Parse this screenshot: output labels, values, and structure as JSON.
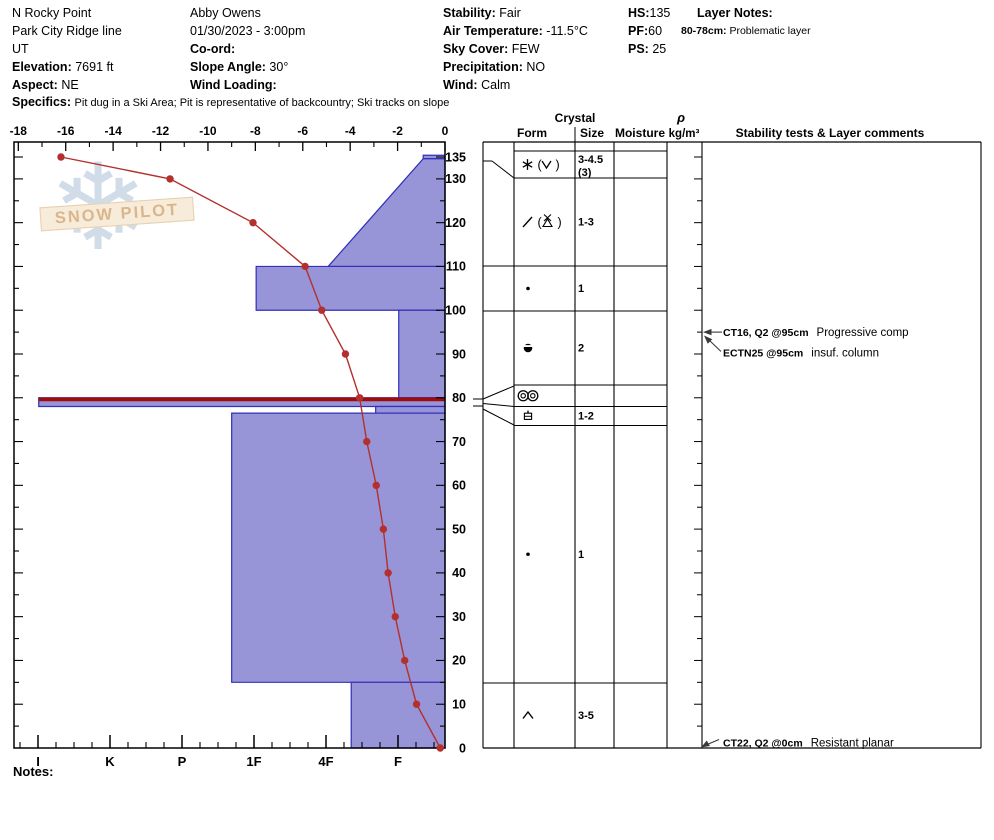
{
  "page": {
    "notes_label": "Notes:"
  },
  "header": {
    "site_name": "N Rocky Point",
    "site_line2": "Park City Ridge line",
    "state": "UT",
    "elevation_label": "Elevation:",
    "elevation_value": "7691 ft",
    "aspect_label": "Aspect:",
    "aspect_value": "NE",
    "specifics_label": "Specifics:",
    "specifics_value": "Pit dug in a Ski Area;  Pit is representative of backcountry;  Ski tracks on slope",
    "observer": "Abby Owens",
    "datetime": "01/30/2023 - 3:00pm",
    "coord_label": "Co-ord:",
    "coord_value": "",
    "slope_angle_label": "Slope Angle:",
    "slope_angle_value": "30°",
    "wind_loading_label": "Wind Loading:",
    "wind_loading_value": "",
    "stability_label": "Stability:",
    "stability_value": "Fair",
    "air_temp_label": "Air Temperature:",
    "air_temp_value": "-11.5°C",
    "sky_cover_label": "Sky Cover:",
    "sky_cover_value": "FEW",
    "precipitation_label": "Precipitation:",
    "precipitation_value": "NO",
    "wind_label": "Wind:",
    "wind_value": "Calm",
    "hs_label": "HS:",
    "hs_value": "135",
    "pf_label": "PF:",
    "pf_value": "60",
    "ps_label": "PS:",
    "ps_value": "25",
    "layer_notes_label": "Layer Notes:",
    "layer_note_depth": "80-78cm:",
    "layer_note_text": "Problematic layer"
  },
  "watermark": {
    "text": "SNOW PILOT",
    "snowflake_icon": "snowflake"
  },
  "chart_data": {
    "type": "snow-profile",
    "temp_axis": {
      "position": "top",
      "unit": "°C",
      "min": -18,
      "max": 0,
      "major_tick_step": 2,
      "minor_tick_step": 1,
      "labels": [
        -18,
        -16,
        -14,
        -12,
        -10,
        -8,
        -6,
        -4,
        -2,
        0
      ]
    },
    "depth_axis": {
      "position": "right",
      "unit": "cm",
      "min": 0,
      "max": 135,
      "minor_tick_step": 5,
      "labels": [
        135,
        130,
        120,
        110,
        100,
        90,
        80,
        70,
        60,
        50,
        40,
        30,
        20,
        10,
        0
      ]
    },
    "hardness_axis": {
      "position": "bottom",
      "labels": [
        "I",
        "K",
        "P",
        "1F",
        "4F",
        "F"
      ]
    },
    "temperature_profile": [
      {
        "depth_cm": 135,
        "temp_c": -16.2
      },
      {
        "depth_cm": 130,
        "temp_c": -11.6
      },
      {
        "depth_cm": 120,
        "temp_c": -8.1
      },
      {
        "depth_cm": 110,
        "temp_c": -5.9
      },
      {
        "depth_cm": 100,
        "temp_c": -5.2
      },
      {
        "depth_cm": 90,
        "temp_c": -4.2
      },
      {
        "depth_cm": 80,
        "temp_c": -3.6
      },
      {
        "depth_cm": 70,
        "temp_c": -3.3
      },
      {
        "depth_cm": 60,
        "temp_c": -2.9
      },
      {
        "depth_cm": 50,
        "temp_c": -2.6
      },
      {
        "depth_cm": 40,
        "temp_c": -2.4
      },
      {
        "depth_cm": 30,
        "temp_c": -2.1
      },
      {
        "depth_cm": 20,
        "temp_c": -1.7
      },
      {
        "depth_cm": 10,
        "temp_c": -1.2
      },
      {
        "depth_cm": 0,
        "temp_c": -0.2
      }
    ],
    "layers": [
      {
        "top_cm": 135.4,
        "bottom_cm": 134.6,
        "hardness": "F-",
        "h_top": 0.65,
        "h_bottom": 0.65
      },
      {
        "top_cm": 134.6,
        "bottom_cm": 110,
        "hardness": "F- to 4F",
        "h_top": 0.65,
        "h_bottom": 1.97
      },
      {
        "top_cm": 110,
        "bottom_cm": 100,
        "hardness": "1F",
        "h_top": 2.97,
        "h_bottom": 2.97
      },
      {
        "top_cm": 100,
        "bottom_cm": 80,
        "hardness": "F",
        "h_top": 0.99,
        "h_bottom": 0.99
      },
      {
        "top_cm": 80,
        "bottom_cm": 78,
        "hardness": "I",
        "h_top": 5.99,
        "h_bottom": 5.99,
        "flagged": true
      },
      {
        "top_cm": 78,
        "bottom_cm": 76.5,
        "hardness": "F+",
        "h_top": 1.31,
        "h_bottom": 1.31
      },
      {
        "top_cm": 76.5,
        "bottom_cm": 15,
        "hardness": "1F+",
        "h_top": 3.31,
        "h_bottom": 3.31
      },
      {
        "top_cm": 15,
        "bottom_cm": 0,
        "hardness": "4F-F",
        "h_top": 1.65,
        "h_bottom": 1.65
      }
    ],
    "grain_rows": [
      {
        "forms": [],
        "size_lines": []
      },
      {
        "forms": [
          "new-snow-star",
          "paren-open",
          "surface-hoar-v",
          "paren-close"
        ],
        "size_lines": [
          "3-4.5",
          "(3)"
        ]
      },
      {
        "forms": [
          "decomposing-slash",
          "paren-open",
          "graupel-triangle-x",
          "paren-close"
        ],
        "size_lines": [
          "1-3"
        ]
      },
      {
        "forms": [
          "rounded-grain-dot"
        ],
        "size_lines": [
          "1"
        ]
      },
      {
        "forms": [
          "circle-notched"
        ],
        "size_lines": [
          "2"
        ]
      },
      {
        "forms": [
          "double-ring-crust"
        ],
        "size_lines": []
      },
      {
        "forms": [
          "square-notched"
        ],
        "size_lines": [
          "1-2"
        ]
      },
      {
        "forms": [
          "rounded-grain-dot"
        ],
        "size_lines": [
          "1"
        ]
      },
      {
        "forms": [
          "depth-hoar-chevron"
        ],
        "size_lines": [
          "3-5"
        ]
      }
    ],
    "table_headers": {
      "crystal": "Crystal",
      "form": "Form",
      "size": "Size",
      "moisture": "Moisture",
      "density_symbol": "ρ",
      "density_unit": "kg/m³",
      "comments": "Stability tests & Layer comments"
    },
    "stability_tests": [
      {
        "bold": "CT16, Q2 @95cm",
        "note": "Progressive comp",
        "depth_cm": 95
      },
      {
        "bold": "ECTN25 @95cm",
        "note": "insuf. column",
        "depth_cm": 95
      },
      {
        "bold": "CT22, Q2 @0cm",
        "note": "Resistant planar",
        "depth_cm": 0
      }
    ],
    "colors": {
      "layer_fill": "#9894d8",
      "layer_border": "#3030b8",
      "flag_red": "#a00b0b",
      "temp_line": "#b3302c",
      "axis": "#000000"
    }
  }
}
